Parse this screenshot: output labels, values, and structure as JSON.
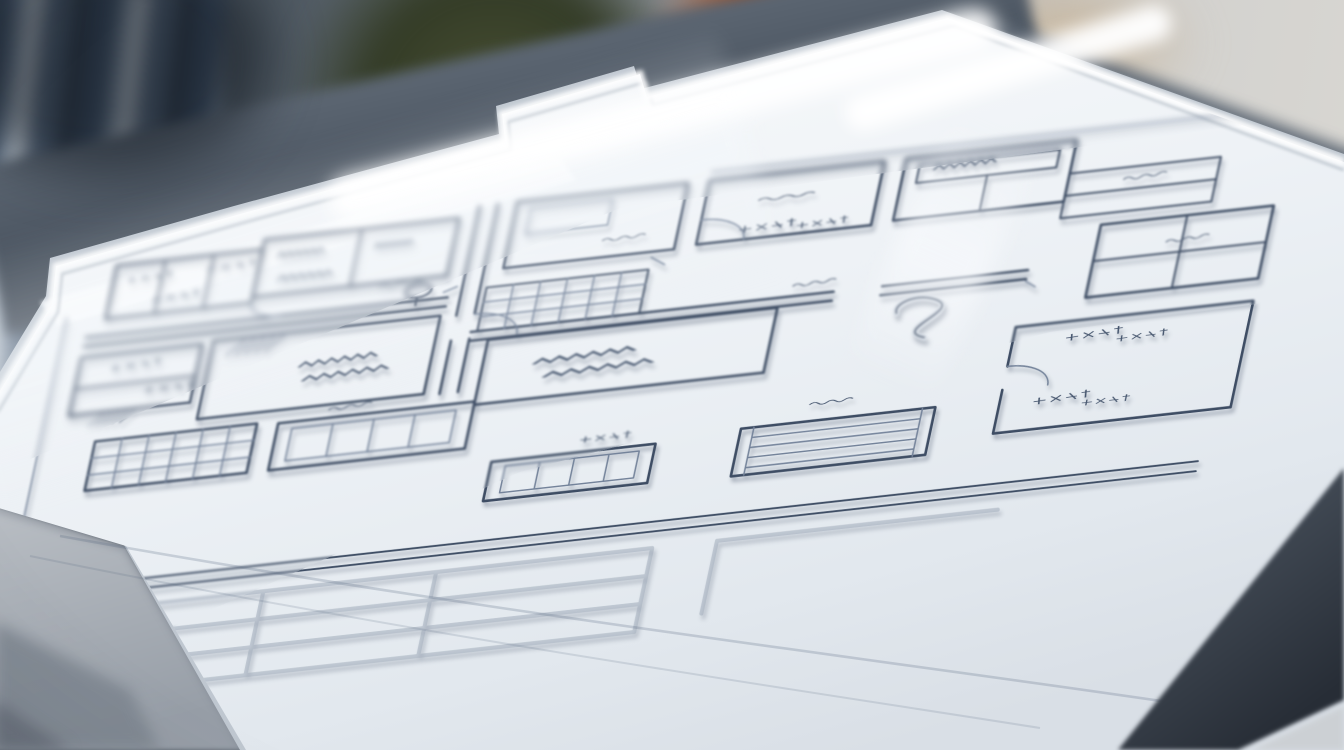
{
  "scene": {
    "label": "Photorealistic close-up of a hand-sketched architectural floor plan on a white drafting board, shallow depth of field",
    "board": {
      "label": "white drafting board with bright beveled edge"
    },
    "floor_plan": {
      "label": "hand-drawn floor plan sketch in dark slate-blue pen",
      "annotations": "illegible handwritten scribble labels (CJK-like glyph clusters and dense zigzag text rows)",
      "features": [
        "room outlines",
        "double-line corridors",
        "door swing arcs",
        "four-pane window grid",
        "tile grids",
        "diagonal hatching",
        "spiral stair ribbon",
        "furniture outlines",
        "double bottom border rule",
        "faint embossed ghost grid on paper"
      ]
    },
    "background": {
      "label": "blurred desk scene",
      "objects": [
        "striped window blind",
        "dark olive-green plant blur",
        "rust-orange object",
        "slate desk band",
        "warm gray wall",
        "gray table surface",
        "dark board-edge shadow band"
      ]
    }
  },
  "palette": {
    "ink": "#3e4d64",
    "ink-light": "#74839a",
    "scribble": "#46566e",
    "ghost": "#a3aebc",
    "paper": "#f2f5f9",
    "board-under": "#bfc7d0",
    "table": "#a8aeb6",
    "slate-band": "#4d5763",
    "orange": "#a84e1e",
    "olive": "#3b4128",
    "stripe-blue": "#45586f",
    "warm-gray": "#d5d3cf",
    "edge-dark": "#2e3540"
  }
}
